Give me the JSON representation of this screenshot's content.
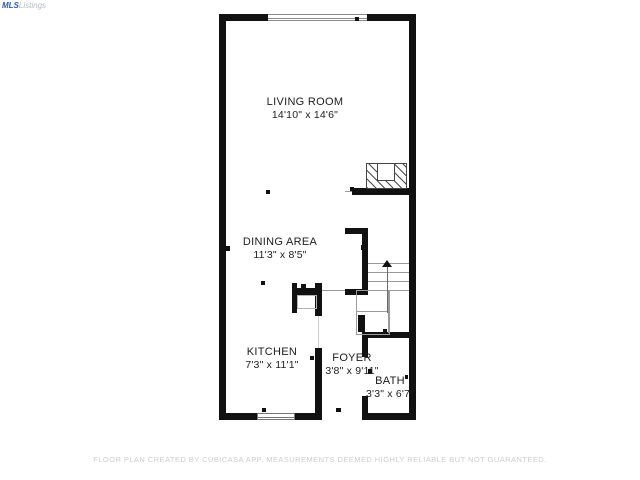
{
  "watermark": {
    "part1": "MLS",
    "part2": "Listings"
  },
  "floor_plan": {
    "rooms": [
      {
        "name": "LIVING ROOM",
        "dims": "14'10\" x 14'6\""
      },
      {
        "name": "DINING AREA",
        "dims": "11'3\" x 8'5\""
      },
      {
        "name": "KITCHEN",
        "dims": "7'3\" x 11'1\""
      },
      {
        "name": "FOYER",
        "dims": "3'8\" x 9'11\""
      },
      {
        "name": "BATH",
        "dims": "3'3\" x 6'7\""
      }
    ],
    "stairs_direction": "up"
  },
  "disclaimer": "FLOOR PLAN CREATED BY CUBICASA APP. MEASUREMENTS DEEMED HIGHLY RELIABLE BUT NOT GUARANTEED.",
  "colors": {
    "wall": "#111111",
    "stair_lines": "#9a9a9a",
    "label_text": "#1c1c1c",
    "disclaimer_text": "#cccccc",
    "logo_blue": "#2b5cad",
    "logo_gray": "#b5b9bd"
  }
}
